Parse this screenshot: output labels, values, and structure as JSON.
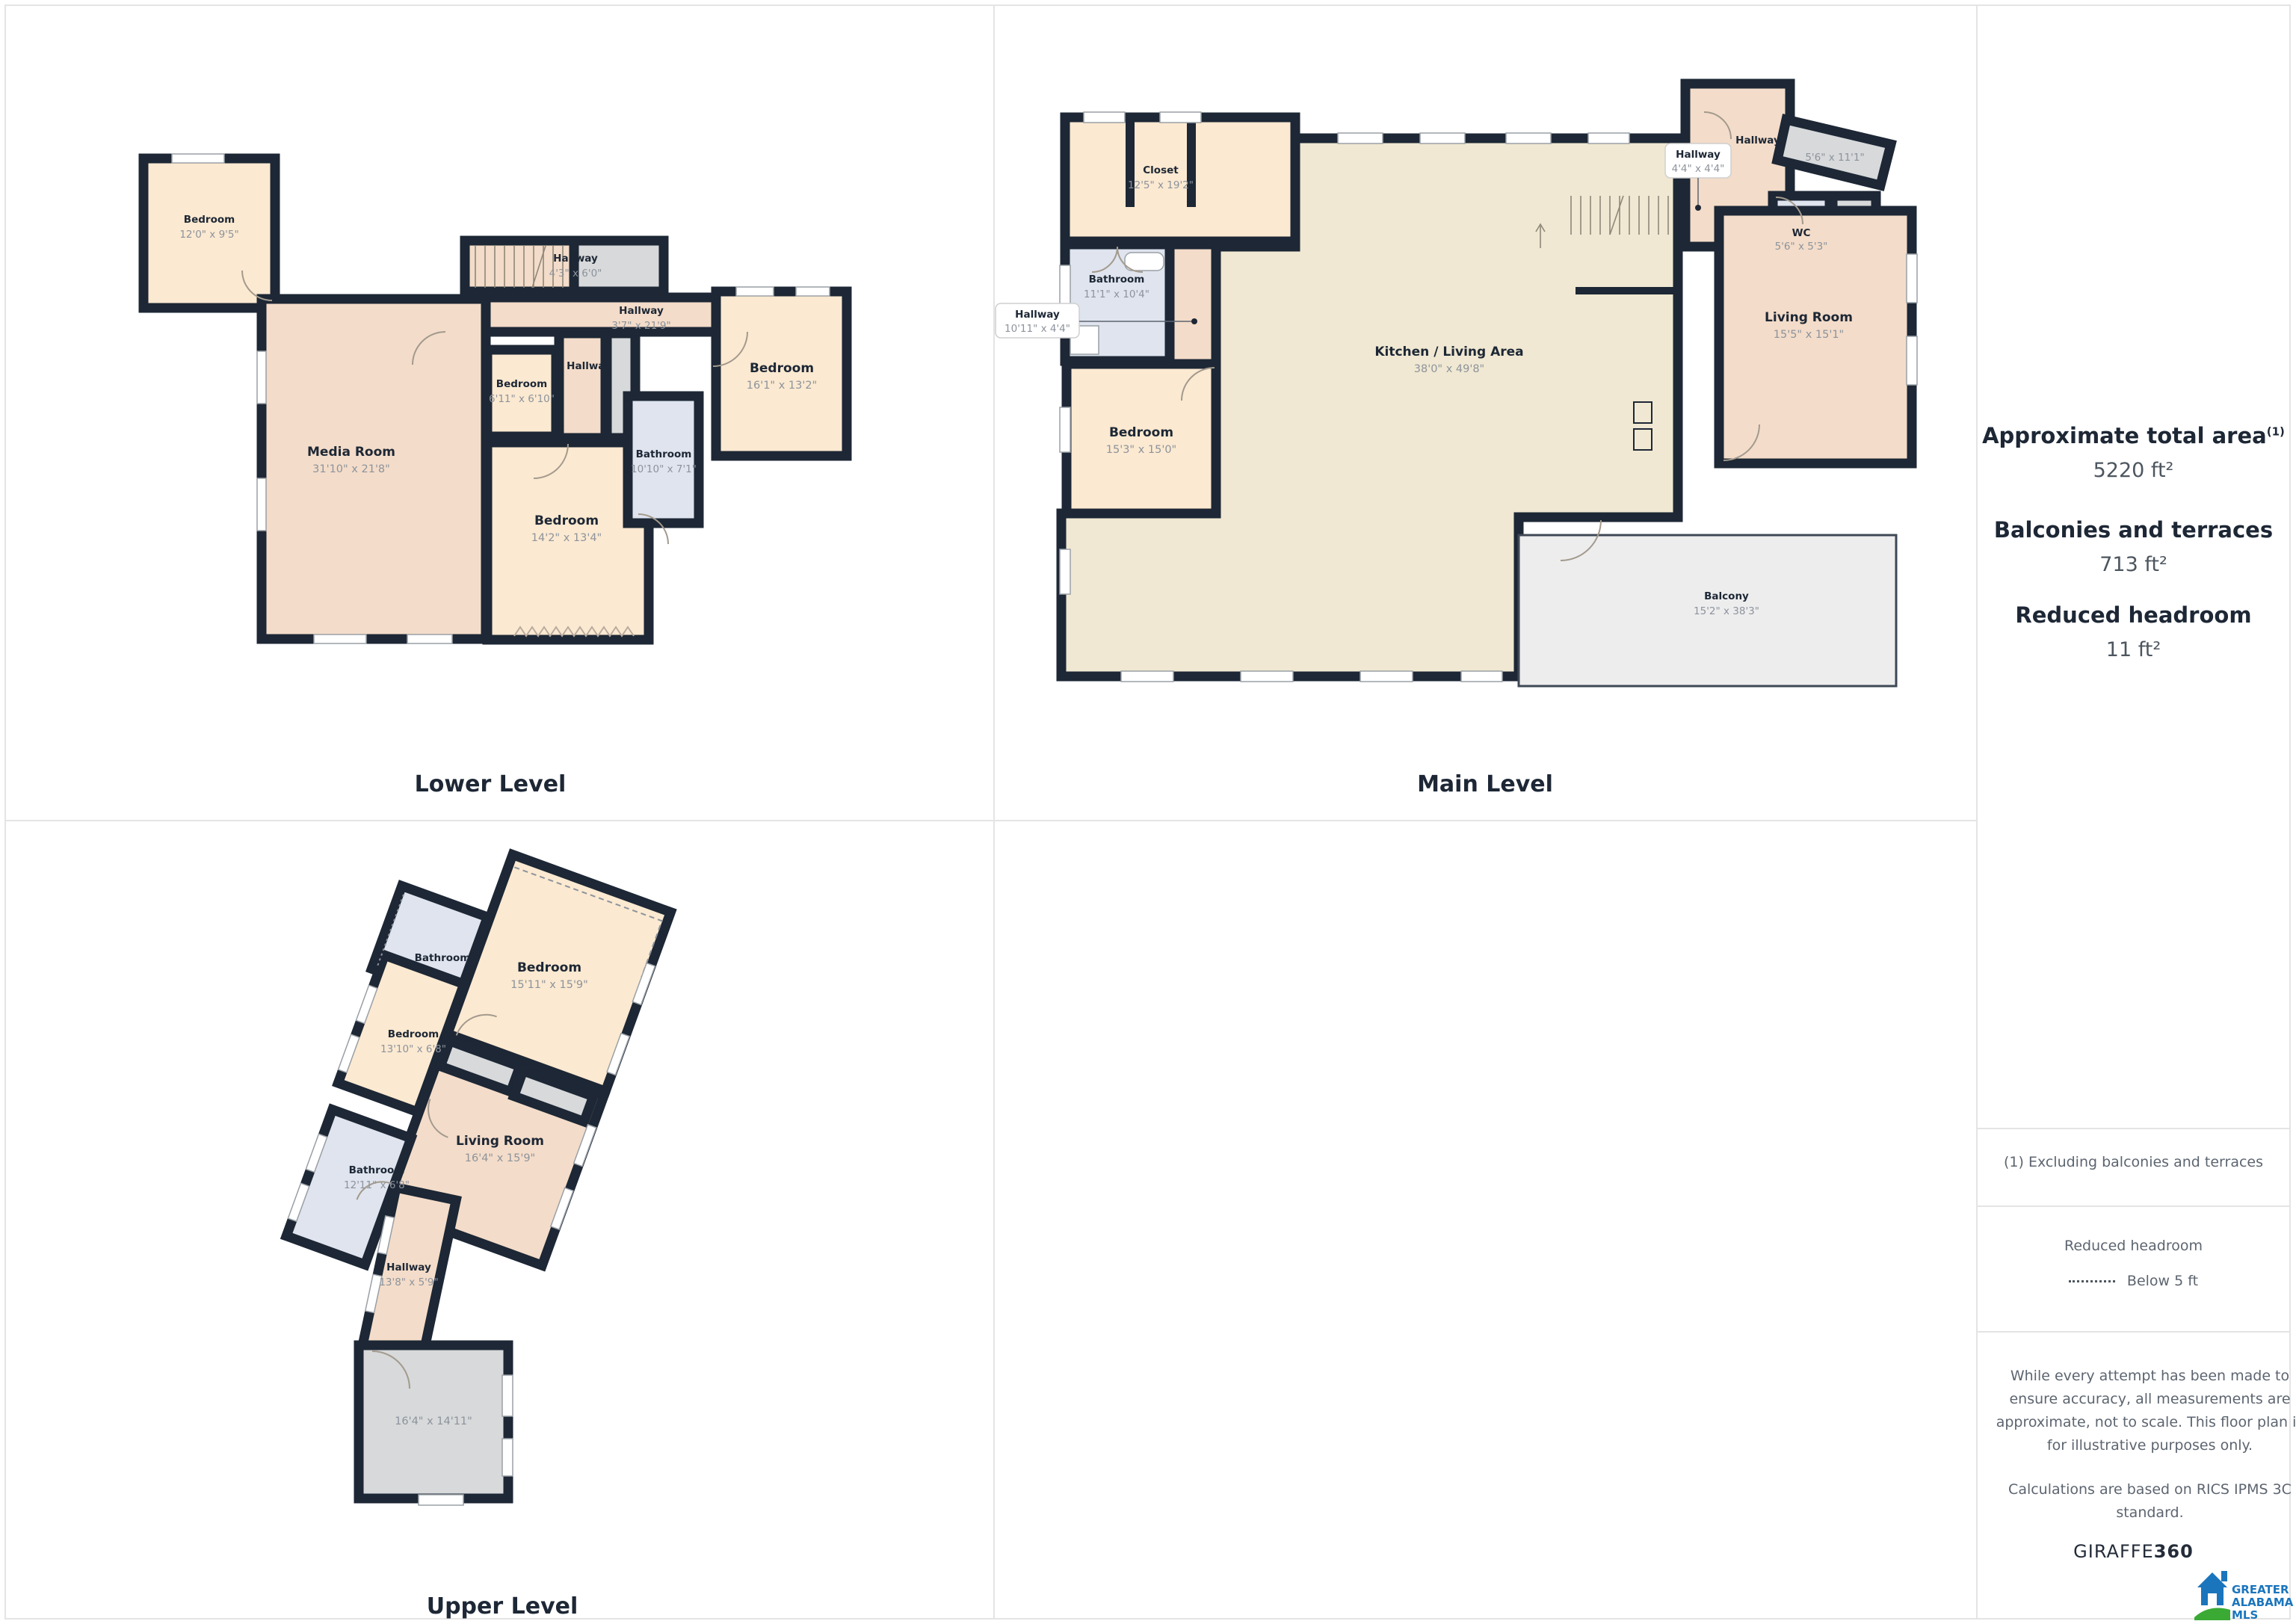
{
  "levels": {
    "lower": {
      "label": "Lower Level"
    },
    "main": {
      "label": "Main Level"
    },
    "upper": {
      "label": "Upper Level"
    }
  },
  "rooms": {
    "lower": {
      "bedroom_nw": {
        "name": "Bedroom",
        "dims": "12'0\" x 9'5\""
      },
      "hallway_stairs": {
        "name": "Hallway",
        "dims": "4'3\" x 6'0\""
      },
      "hallway_main": {
        "name": "Hallway",
        "dims": "3'7\" x 21'9\""
      },
      "hallway_small": {
        "name": "Hallway"
      },
      "media_room": {
        "name": "Media Room",
        "dims": "31'10\" x 21'8\""
      },
      "bedroom_small": {
        "name": "Bedroom",
        "dims": "6'11\" x 6'10\""
      },
      "bedroom_mid": {
        "name": "Bedroom",
        "dims": "14'2\" x 13'4\""
      },
      "bathroom": {
        "name": "Bathroom",
        "dims": "10'10\" x 7'1\""
      },
      "bedroom_right": {
        "name": "Bedroom",
        "dims": "16'1\" x 13'2\""
      }
    },
    "main": {
      "closet": {
        "name": "Closet",
        "dims": "12'5\" x 19'2\""
      },
      "bathroom": {
        "name": "Bathroom",
        "dims": "11'1\" x 10'4\""
      },
      "hallway_left": {
        "name": "Hallway",
        "dims": "10'11\" x 4'4\""
      },
      "bedroom": {
        "name": "Bedroom",
        "dims": "15'3\" x 15'0\""
      },
      "kitchen": {
        "name": "Kitchen / Living Area",
        "dims": "38'0\" x 49'8\""
      },
      "hallway_top": {
        "name": "Hallway"
      },
      "hallway_mid": {
        "name": "Hallway",
        "dims": "4'4\" x 4'4\""
      },
      "terrace": {
        "dims": "5'6\" x 11'1\""
      },
      "wc": {
        "name": "WC",
        "dims": "5'6\" x 5'3\""
      },
      "living_room": {
        "name": "Living Room",
        "dims": "15'5\" x 15'1\""
      },
      "balcony": {
        "name": "Balcony",
        "dims": "15'2\" x 38'3\""
      }
    },
    "upper": {
      "bathroom_top": {
        "name": "Bathroom"
      },
      "bedroom_large": {
        "name": "Bedroom",
        "dims": "15'11\" x 15'9\""
      },
      "bedroom_small": {
        "name": "Bedroom",
        "dims": "13'10\" x 6'8\""
      },
      "living_room": {
        "name": "Living Room",
        "dims": "16'4\" x 15'9\""
      },
      "bathroom": {
        "name": "Bathroom",
        "dims": "12'11\" x 6'8\""
      },
      "hallway": {
        "name": "Hallway",
        "dims": "13'8\" x 5'9\""
      },
      "storage": {
        "dims": "16'4\" x 14'11\""
      }
    }
  },
  "sidebar": {
    "total": {
      "title": "Approximate total area",
      "sup": "(1)",
      "value": "5220 ft²"
    },
    "balconies": {
      "title": "Balconies and terraces",
      "value": "713 ft²"
    },
    "headroom": {
      "title": "Reduced headroom",
      "value": "11 ft²"
    },
    "footnote": "(1) Excluding balconies and terraces",
    "legend": {
      "title": "Reduced headroom",
      "label": "Below 5 ft"
    },
    "disclaimer_1": "While every attempt has been made to ensure accuracy, all measurements are approximate, not to scale. This floor plan is for illustrative purposes only.",
    "disclaimer_2": "Calculations are based on RICS IPMS 3C standard.",
    "brand": {
      "name": "GIRAFFE",
      "suffix": "360"
    },
    "mls": {
      "line1": "GREATER",
      "line2": "ALABAMA",
      "line3": "MLS"
    }
  },
  "colors": {
    "wall": "#1d2735",
    "peach": "#fbe9d1",
    "pink": "#f3dcc9",
    "beige": "#f0e8d2",
    "bath": "#dfe4ee",
    "gray": "#d7d9da",
    "balcony": "#ededee",
    "dim_text": "#8d939c",
    "mls_blue": "#1b75bc",
    "mls_green": "#3aaa35"
  }
}
